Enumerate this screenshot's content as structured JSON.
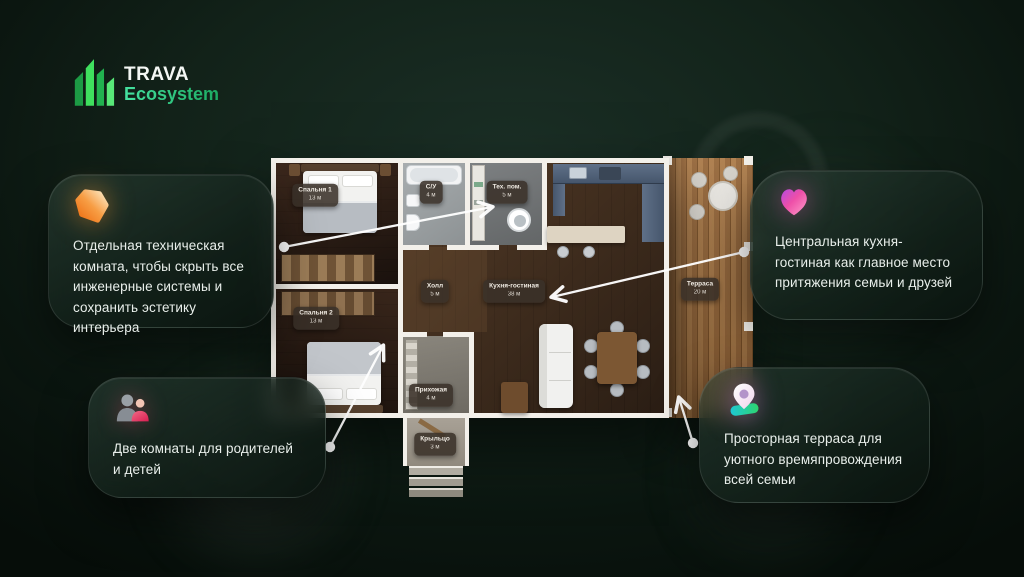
{
  "brand": {
    "name": "TRAVA",
    "sub": "Ecosystem"
  },
  "callouts": {
    "tech_room": {
      "icon": "crystal-icon",
      "text": "Отдельная техническая комната, чтобы скрыть все инженерные системы и сохранить эстетику интерьера"
    },
    "kitchen_living": {
      "icon": "heart-icon",
      "text": "Центральная кухня-гостиная как главное место притяжения семьи и друзей"
    },
    "bedrooms": {
      "icon": "people-icon",
      "text": "Две комнаты для родителей и детей"
    },
    "terrace": {
      "icon": "location-pin-icon",
      "text": "Просторная терраса для уютного времяпровождения всей семьи"
    }
  },
  "floorplan": {
    "rooms": [
      {
        "name": "Спальня 1",
        "area": "13 м"
      },
      {
        "name": "С/У",
        "area": "4 м"
      },
      {
        "name": "Тех. пом.",
        "area": "5 м"
      },
      {
        "name": "Спальня 2",
        "area": "13 м"
      },
      {
        "name": "Холл",
        "area": "5 м"
      },
      {
        "name": "Кухня-гостиная",
        "area": "38 м"
      },
      {
        "name": "Терраса",
        "area": "20 м"
      },
      {
        "name": "Прихожая",
        "area": "4 м"
      },
      {
        "name": "Крыльцо",
        "area": "3 м"
      }
    ]
  },
  "colors": {
    "background": "#0e1d16",
    "logo_green_bright": "#3fe05e",
    "logo_green_dark": "#1c9a44",
    "ecosystem_gradient": [
      "#45e2a0",
      "#1cab62"
    ],
    "card_text": "#e9efeb",
    "connector_line": "#ffffff",
    "crystal_orange": "#f29138",
    "heart_pink": "#ee4fa8",
    "heart_purple": "#b44be0",
    "people_pink": "#e84d74",
    "pin_teal": "#1ec8d4",
    "pin_green": "#2ed46e",
    "terrace_wood": "#a0703f",
    "badge_bg": "#3a3129"
  }
}
